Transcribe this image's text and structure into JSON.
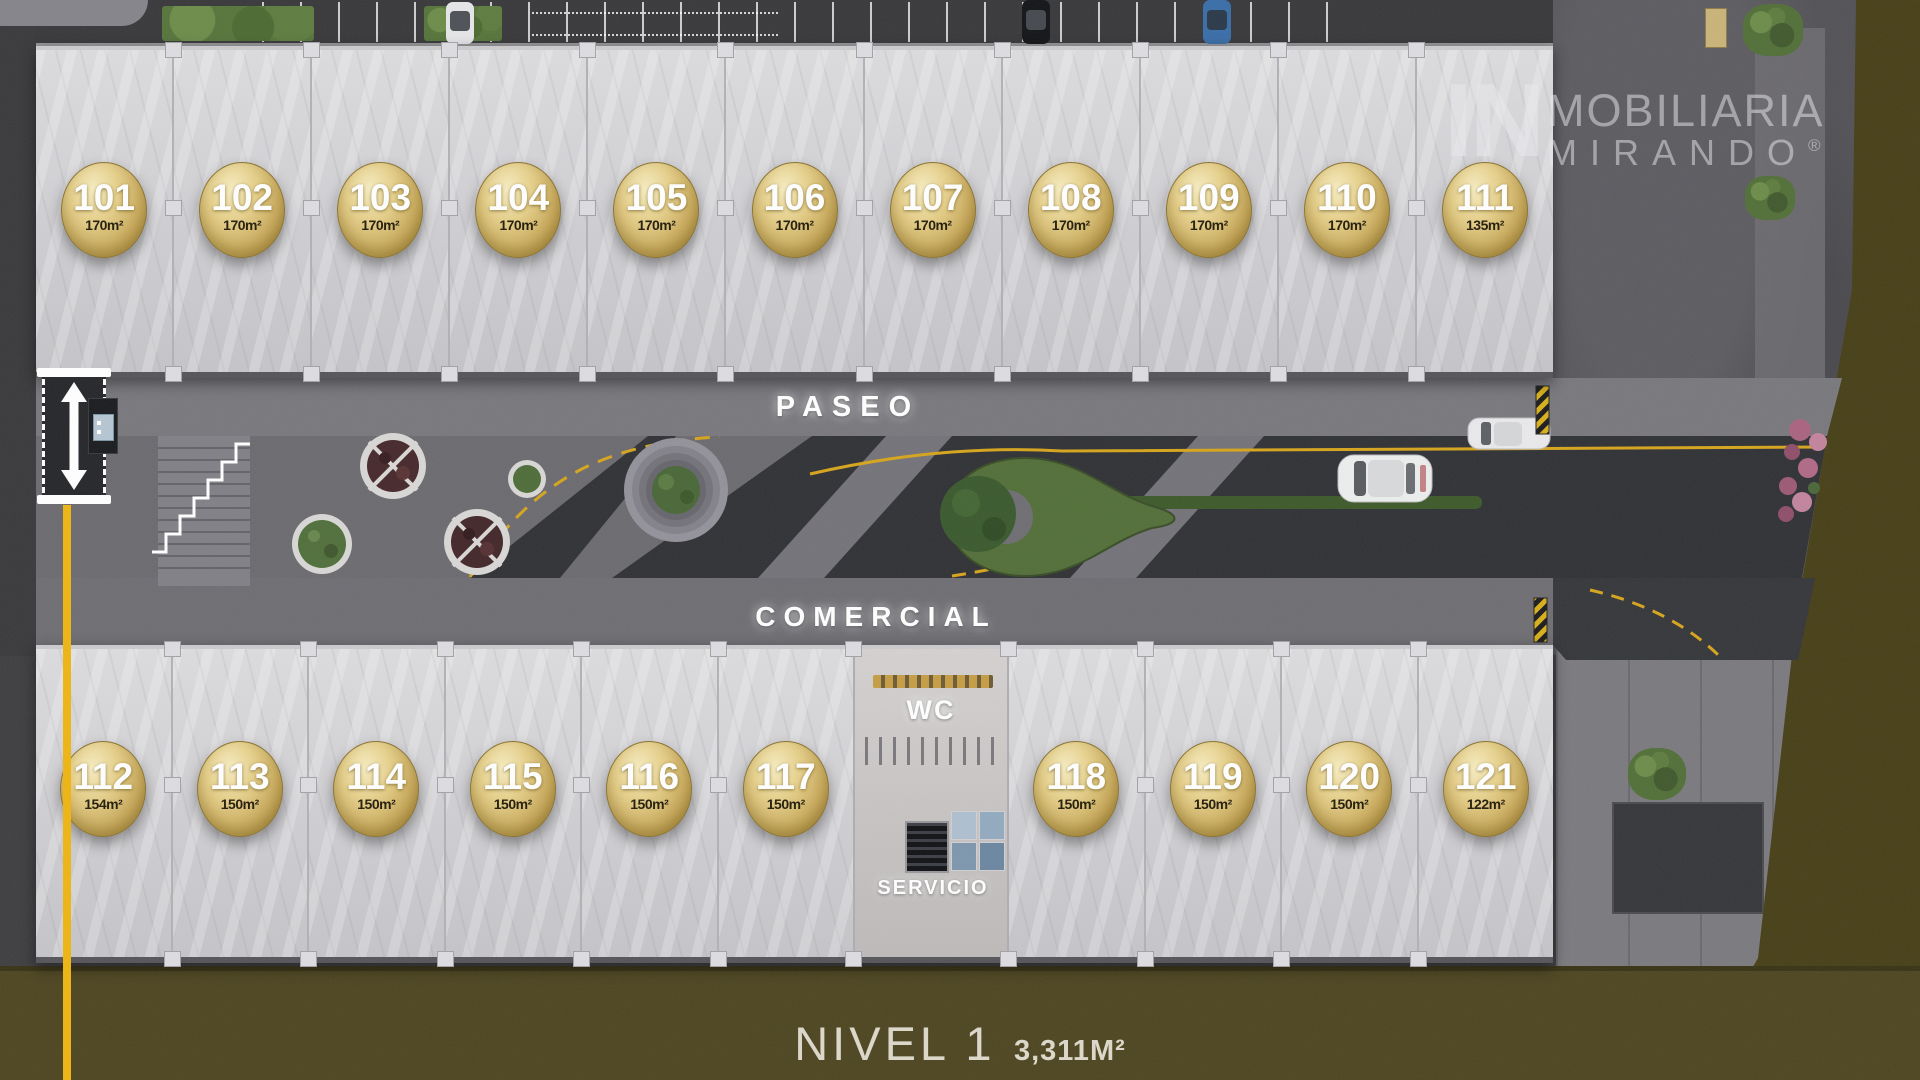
{
  "branding": {
    "logo_in": "IN",
    "logo_name": "MOBILIARIA",
    "logo_sub": "MIRANDO",
    "logo_registered": "®"
  },
  "plan_labels": {
    "paseo": "PASEO",
    "comercial": "COMERCIAL",
    "wc": "WC",
    "servicio": "SERVICIO"
  },
  "level_summary": {
    "name": "NIVEL 1",
    "total_area": "3,311M²"
  },
  "units_top": [
    {
      "number": "101",
      "area": "170m²"
    },
    {
      "number": "102",
      "area": "170m²"
    },
    {
      "number": "103",
      "area": "170m²"
    },
    {
      "number": "104",
      "area": "170m²"
    },
    {
      "number": "105",
      "area": "170m²"
    },
    {
      "number": "106",
      "area": "170m²"
    },
    {
      "number": "107",
      "area": "170m²"
    },
    {
      "number": "108",
      "area": "170m²"
    },
    {
      "number": "109",
      "area": "170m²"
    },
    {
      "number": "110",
      "area": "170m²"
    },
    {
      "number": "111",
      "area": "135m²"
    }
  ],
  "units_bottom_left": [
    {
      "number": "112",
      "area": "154m²"
    },
    {
      "number": "113",
      "area": "150m²"
    },
    {
      "number": "114",
      "area": "150m²"
    },
    {
      "number": "115",
      "area": "150m²"
    },
    {
      "number": "116",
      "area": "150m²"
    },
    {
      "number": "117",
      "area": "150m²"
    }
  ],
  "units_bottom_right": [
    {
      "number": "118",
      "area": "150m²"
    },
    {
      "number": "119",
      "area": "150m²"
    },
    {
      "number": "120",
      "area": "150m²"
    },
    {
      "number": "121",
      "area": "122m²"
    }
  ],
  "colors": {
    "badge_gold": "#d9bf72",
    "accent_yellow": "#eeb513",
    "olive_ground": "#4b431f",
    "marble": "#d6d5d7",
    "asphalt": "#2f3134",
    "walkway_stone": "#76757a"
  }
}
